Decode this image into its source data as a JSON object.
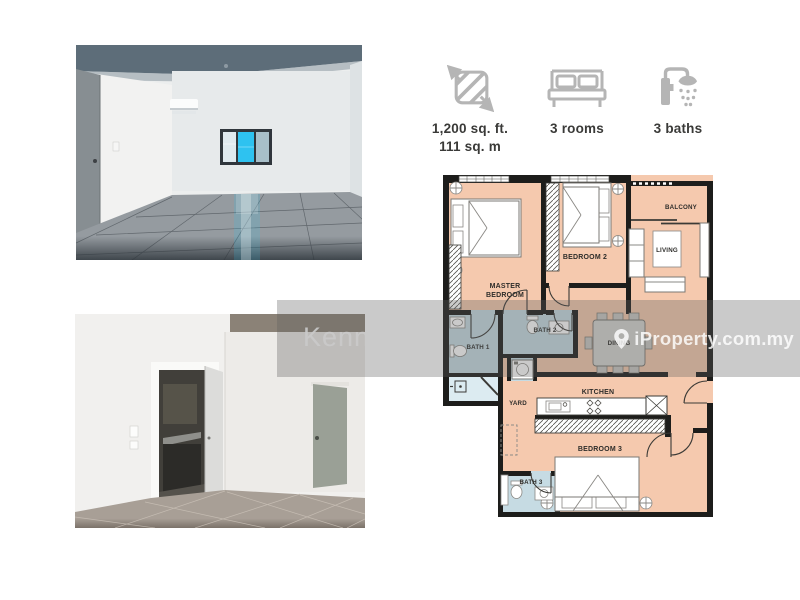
{
  "colors": {
    "room_fill": "#f5c9ae",
    "bath_fill": "#c6dbe3",
    "store_fill": "#dcebf1",
    "wall": "#1d1d1b",
    "plan_label": "#2e2d2a",
    "icon_gray": "#b5b5b5",
    "stat_text": "#3a3a38",
    "watermark_band": "rgba(95,95,95,0.33)",
    "watermark_text": "rgba(255,255,255,0.82)"
  },
  "stats": {
    "area": {
      "icon": "area-measure-icon",
      "line1": "1,200 sq. ft.",
      "line2": "111 sq. m"
    },
    "rooms": {
      "icon": "bed-icon",
      "label": "3 rooms"
    },
    "baths": {
      "icon": "shower-icon",
      "label": "3 baths"
    }
  },
  "floorplan": {
    "labels": {
      "master_line1": "MASTER",
      "master_line2": "BEDROOM",
      "bedroom2": "BEDROOM 2",
      "balcony": "BALCONY",
      "living": "LIVING",
      "bath1": "BATH 1",
      "bath2": "BATH 2",
      "dining": "DINING",
      "yard": "YARD",
      "kitchen": "KITCHEN",
      "bedroom3": "BEDROOM 3",
      "bath3": "BATH 3"
    }
  },
  "watermarks": {
    "agent": "Kenn",
    "brand": "iProperty.com.my",
    "brand_icon": "map-pin-icon"
  }
}
